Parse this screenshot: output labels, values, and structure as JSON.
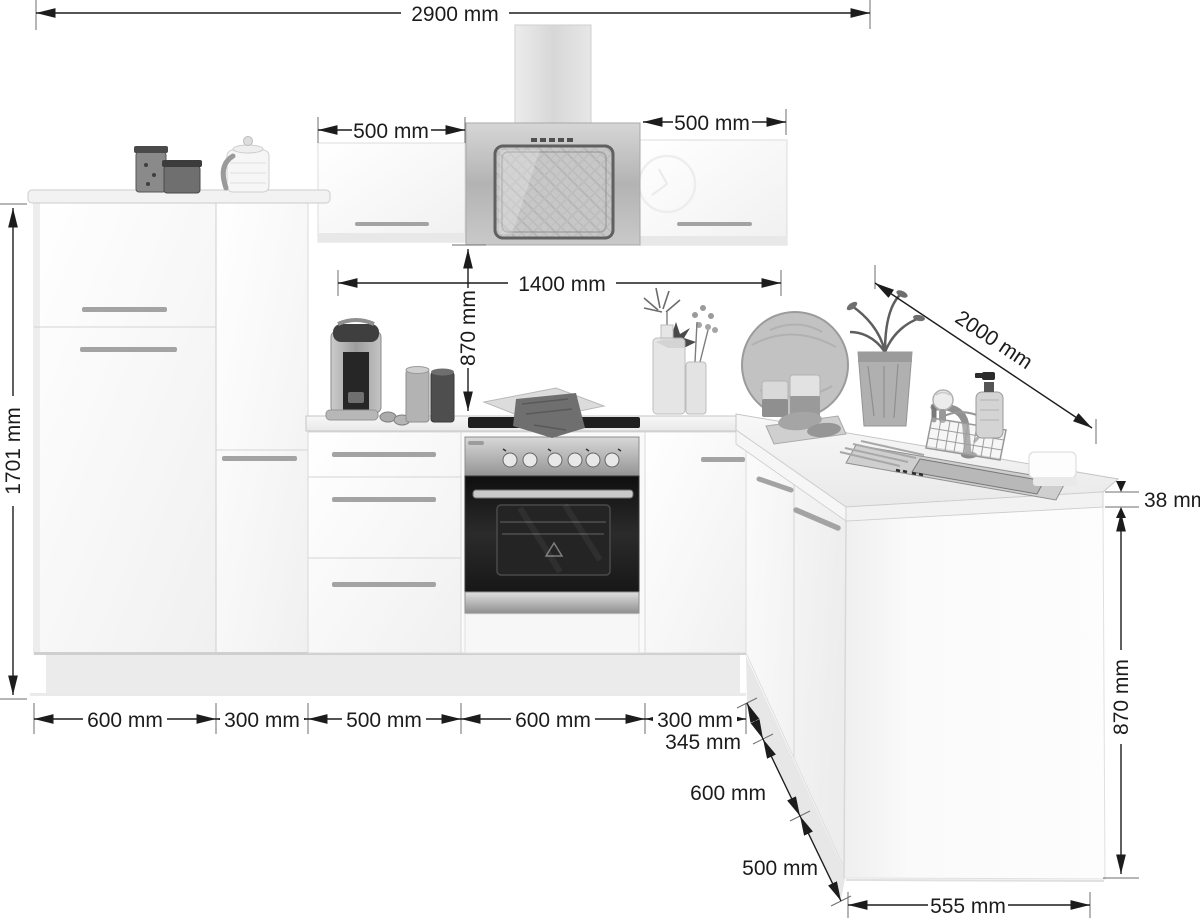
{
  "diagram": {
    "type": "kitchen-elevation-dimension-diagram",
    "subject": "L-shaped fitted kitchen with wall units, range hood, oven and corner sink run",
    "unit": "mm"
  },
  "dimensions": {
    "overall_width": "2900 mm",
    "wall_cabinet_left_width": "500 mm",
    "wall_cabinet_right_width": "500 mm",
    "wall_unit_span": "1400 mm",
    "worktop_to_wall_unit": "870 mm",
    "tall_unit_height": "1701 mm",
    "side_run_depth": "2000 mm",
    "worktop_thickness": "38 mm",
    "base_unit_height": "870 mm",
    "end_panel_width": "555 mm",
    "base_run": [
      "600 mm",
      "300 mm",
      "500 mm",
      "600 mm",
      "300 mm"
    ],
    "side_run": [
      "345 mm",
      "600 mm",
      "500 mm"
    ]
  },
  "colors": {
    "background": "#ffffff",
    "dimension_lines": "#1c1c1c",
    "cabinet_fronts": "#fafafa",
    "stainless_steel": "#b5b5b5",
    "oven_door": "#1b1b1b"
  }
}
